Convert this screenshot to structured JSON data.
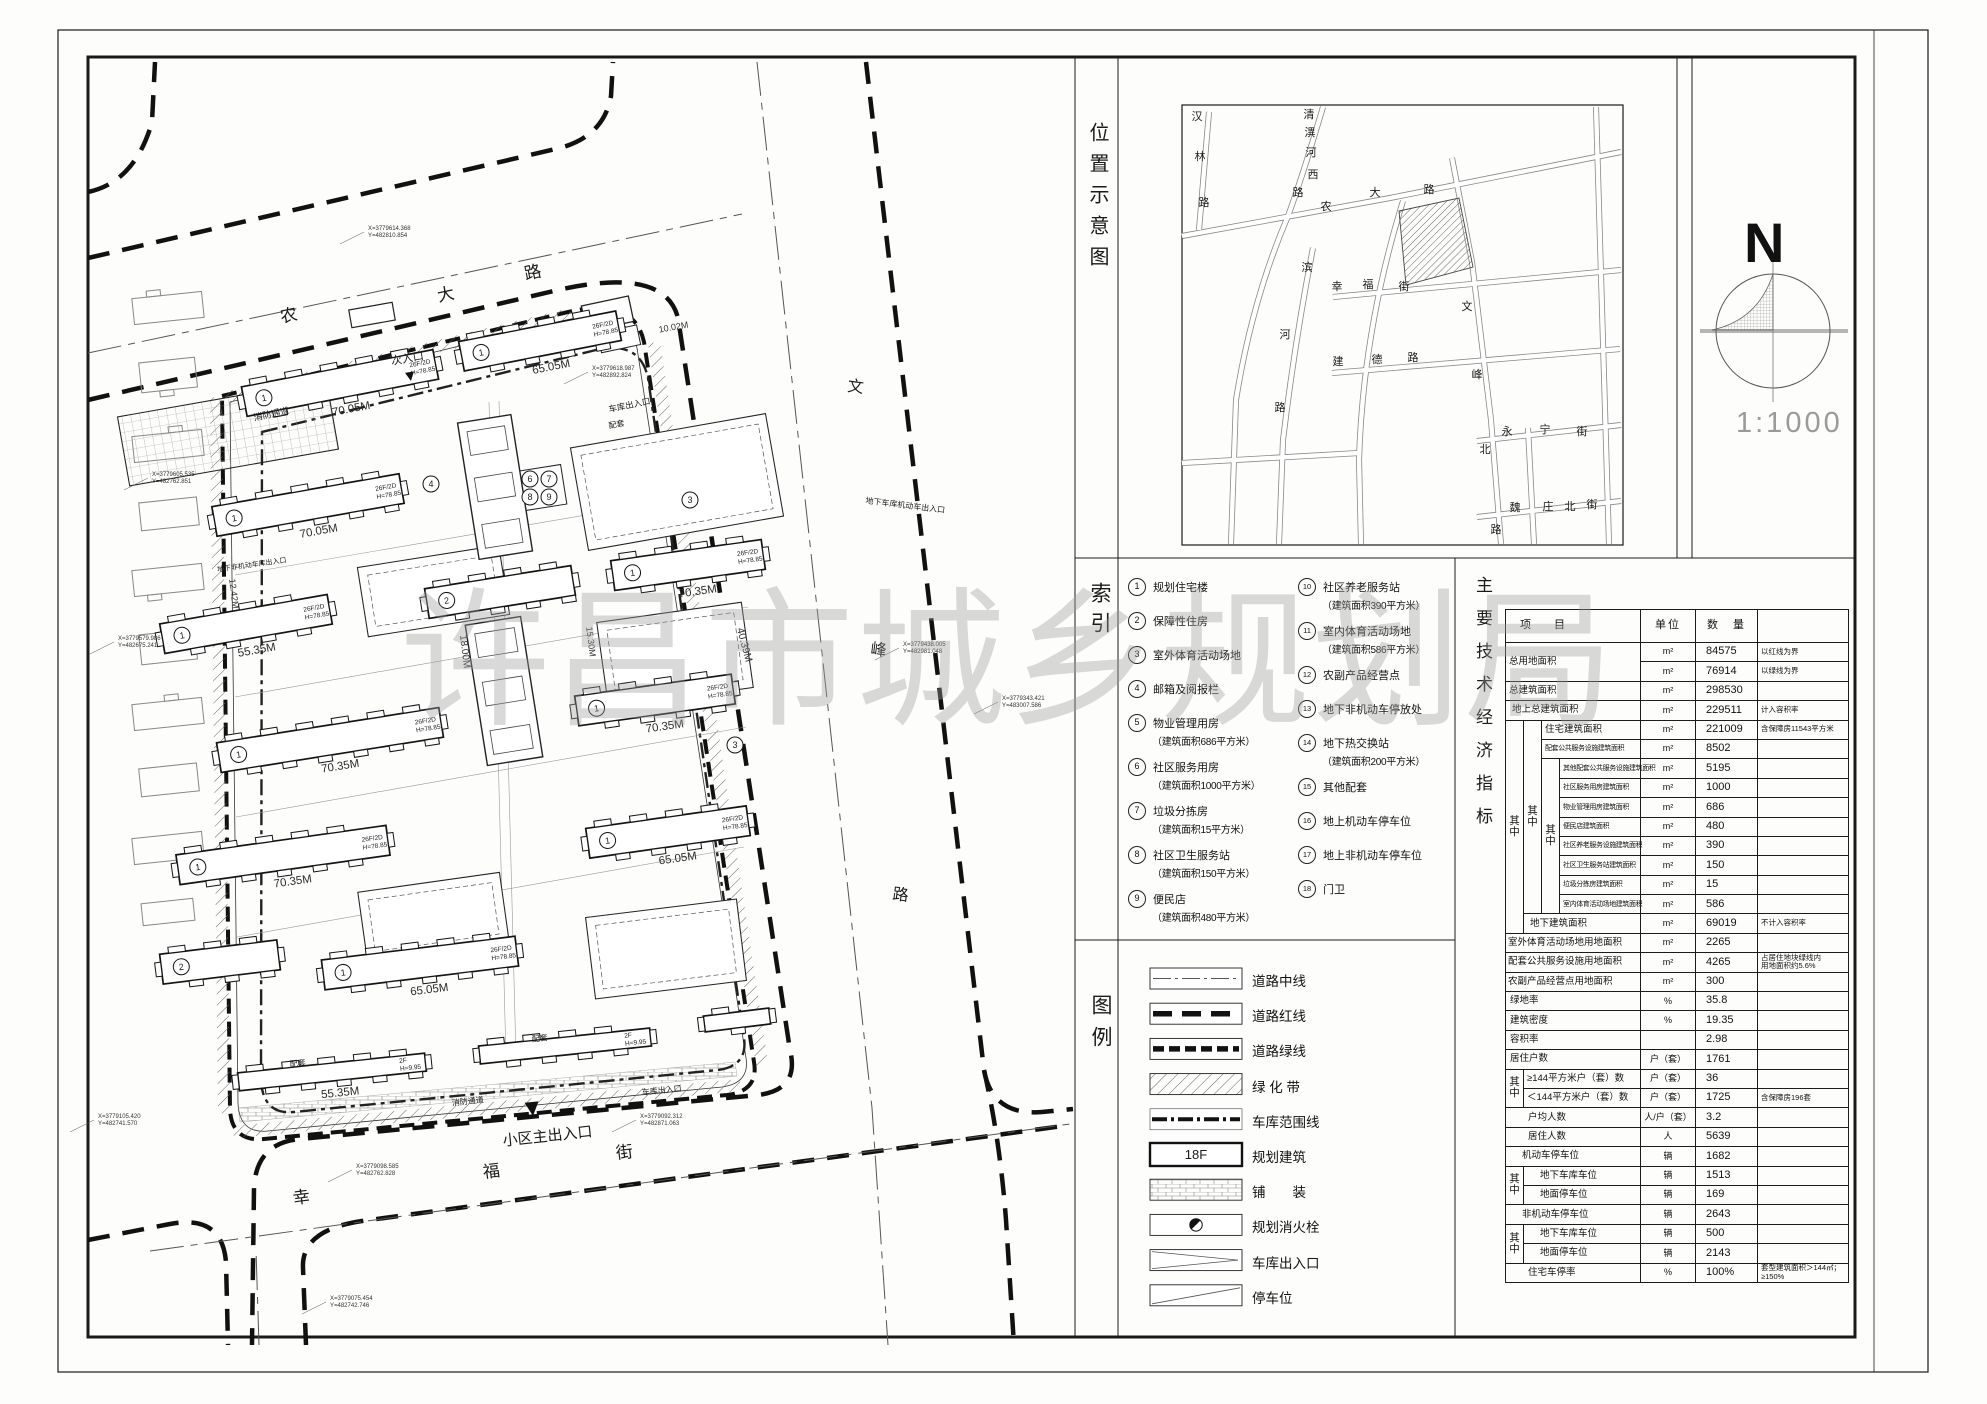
{
  "sheet": {
    "watermark": "许昌市城乡规划局"
  },
  "panels": {
    "location_label": "位置示意图",
    "index_label": "索引",
    "legend_label": "图例",
    "indicators_label": "主要技术经济指标"
  },
  "north": {
    "letter": "N",
    "scale": "1:1000"
  },
  "location_map": {
    "streets": [
      {
        "name": "汉林路",
        "pos": [
          [
            1197,
            120
          ],
          [
            1200,
            160
          ],
          [
            1204,
            206
          ]
        ]
      },
      {
        "name": "清潩河西路",
        "pos": [
          [
            1309,
            118
          ],
          [
            1310,
            136
          ],
          [
            1311,
            156
          ],
          [
            1313,
            178
          ],
          [
            1298,
            196
          ]
        ]
      },
      {
        "name": "农大路",
        "pos": [
          [
            1326,
            210
          ],
          [
            1375,
            196
          ],
          [
            1429,
            193
          ]
        ]
      },
      {
        "name": "滨河路",
        "pos": [
          [
            1307,
            271
          ],
          [
            1285,
            338
          ],
          [
            1280,
            411
          ]
        ]
      },
      {
        "name": "幸福街",
        "pos": [
          [
            1337,
            290
          ],
          [
            1368,
            288
          ],
          [
            1404,
            290
          ]
        ]
      },
      {
        "name": "文峰北路",
        "pos": [
          [
            1467,
            310
          ],
          [
            1477,
            378
          ],
          [
            1485,
            453
          ],
          [
            1496,
            533
          ]
        ]
      },
      {
        "name": "建德路",
        "pos": [
          [
            1338,
            365
          ],
          [
            1377,
            363
          ],
          [
            1413,
            361
          ]
        ]
      },
      {
        "name": "永宁街",
        "pos": [
          [
            1507,
            435
          ],
          [
            1545,
            433
          ],
          [
            1582,
            435
          ]
        ]
      },
      {
        "name": "魏庄北街",
        "pos": [
          [
            1515,
            511
          ],
          [
            1548,
            510
          ],
          [
            1570,
            510
          ],
          [
            1592,
            508
          ]
        ]
      }
    ]
  },
  "index": {
    "col1": [
      {
        "no": "1",
        "text": "规划住宅楼",
        "sub": ""
      },
      {
        "no": "2",
        "text": "保障性住房",
        "sub": ""
      },
      {
        "no": "3",
        "text": "室外体育活动场地",
        "sub": ""
      },
      {
        "no": "4",
        "text": "邮箱及阅报栏",
        "sub": ""
      },
      {
        "no": "5",
        "text": "物业管理用房",
        "sub": "（建筑面积686平方米）"
      },
      {
        "no": "6",
        "text": "社区服务用房",
        "sub": "（建筑面积1000平方米）"
      },
      {
        "no": "7",
        "text": "垃圾分拣房",
        "sub": "（建筑面积15平方米）"
      },
      {
        "no": "8",
        "text": "社区卫生服务站",
        "sub": "（建筑面积150平方米）"
      },
      {
        "no": "9",
        "text": "便民店",
        "sub": "（建筑面积480平方米）"
      }
    ],
    "col2": [
      {
        "no": "10",
        "text": "社区养老服务站",
        "sub": "（建筑面积390平方米）"
      },
      {
        "no": "11",
        "text": "室内体育活动场地",
        "sub": "（建筑面积586平方米）"
      },
      {
        "no": "12",
        "text": "农副产品经营点",
        "sub": ""
      },
      {
        "no": "13",
        "text": "地下非机动车停放处",
        "sub": ""
      },
      {
        "no": "14",
        "text": "地下热交换站",
        "sub": "（建筑面积200平方米）"
      },
      {
        "no": "15",
        "text": "其他配套",
        "sub": ""
      },
      {
        "no": "16",
        "text": "地上机动车停车位",
        "sub": ""
      },
      {
        "no": "17",
        "text": "地上非机动车停车位",
        "sub": ""
      },
      {
        "no": "18",
        "text": "门卫",
        "sub": ""
      }
    ]
  },
  "legend": {
    "floor": "18F",
    "items": [
      {
        "sym": "centerline",
        "label": "道路中线"
      },
      {
        "sym": "redline",
        "label": "道路红线"
      },
      {
        "sym": "greenline",
        "label": "道路绿线"
      },
      {
        "sym": "greenbelt",
        "label": "绿 化 带"
      },
      {
        "sym": "garage",
        "label": "车库范围线"
      },
      {
        "sym": "building",
        "label": "规划建筑"
      },
      {
        "sym": "paving",
        "label": "铺　　装"
      },
      {
        "sym": "hydrant",
        "label": "规划消火栓"
      },
      {
        "sym": "ramp",
        "label": "车库出入口"
      },
      {
        "sym": "parking",
        "label": "停车位"
      }
    ]
  },
  "table": {
    "qz": "其中",
    "headers": {
      "item": "项　目",
      "unit": "单位",
      "qty": "数　量",
      "remark": ""
    },
    "rows": [
      {
        "l": "总用地面积",
        "lrs": 2,
        "cs": 4,
        "u": "m²",
        "q": "84575",
        "r": "以红线为界"
      },
      {
        "l": null,
        "u": "m²",
        "q": "76914",
        "r": "以绿线为界"
      },
      {
        "l": "总建筑面积",
        "cs": 4,
        "u": "m²",
        "q": "298530",
        "r": ""
      },
      {
        "l": "地上总建筑面积",
        "cs": 4,
        "pad": 6,
        "u": "m²",
        "q": "229511",
        "r": "计入容积率"
      },
      {
        "l": "住宅建筑面积",
        "cs": 2,
        "pre": [
          {
            "rs": 11
          },
          {
            "rs": 10
          }
        ],
        "u": "m²",
        "q": "221009",
        "r": "含保障房11543平方米"
      },
      {
        "l": "配套公共服务设施建筑面积",
        "cs": 2,
        "cls": "sm",
        "u": "m²",
        "q": "8502",
        "r": ""
      },
      {
        "l": "其他配套公共服务设施建筑面积",
        "cs": 1,
        "cls": "sm",
        "pre": [
          {
            "rs": 8
          }
        ],
        "u": "m²",
        "q": "5195",
        "r": ""
      },
      {
        "l": "社区服务用房建筑面积",
        "cs": 1,
        "cls": "sm",
        "u": "m²",
        "q": "1000",
        "r": ""
      },
      {
        "l": "物业管理用房建筑面积",
        "cs": 1,
        "cls": "sm",
        "u": "m²",
        "q": "686",
        "r": ""
      },
      {
        "l": "便民店建筑面积",
        "cs": 1,
        "cls": "sm",
        "u": "m²",
        "q": "480",
        "r": ""
      },
      {
        "l": "社区养老服务设施建筑面积",
        "cs": 1,
        "cls": "sm",
        "u": "m²",
        "q": "390",
        "r": ""
      },
      {
        "l": "社区卫生服务站建筑面积",
        "cs": 1,
        "cls": "sm",
        "u": "m²",
        "q": "150",
        "r": ""
      },
      {
        "l": "垃圾分拣房建筑面积",
        "cs": 1,
        "cls": "sm",
        "u": "m²",
        "q": "15",
        "r": ""
      },
      {
        "l": "室内体育活动场地建筑面积",
        "cs": 1,
        "cls": "sm",
        "u": "m²",
        "q": "586",
        "r": ""
      },
      {
        "l": "地下建筑面积",
        "cs": 3,
        "pad": 6,
        "u": "m²",
        "q": "69019",
        "r": "不计入容积率"
      },
      {
        "l": "室外体育活动场地用地面积",
        "cs": 4,
        "pad": 2,
        "u": "m²",
        "q": "2265",
        "r": ""
      },
      {
        "l": "配套公共服务设施用地面积",
        "cs": 4,
        "pad": 2,
        "u": "m²",
        "q": "4265",
        "r": "占居住地块绿线内\n用地面积约5.6%"
      },
      {
        "l": "农副产品经营点用地面积",
        "cs": 4,
        "pad": 2,
        "u": "m²",
        "q": "300",
        "r": ""
      },
      {
        "l": "绿地率",
        "cs": 4,
        "pad": 4,
        "u": "%",
        "q": "35.8",
        "r": ""
      },
      {
        "l": "建筑密度",
        "cs": 4,
        "pad": 4,
        "u": "%",
        "q": "19.35",
        "r": ""
      },
      {
        "l": "容积率",
        "cs": 4,
        "pad": 4,
        "u": "",
        "q": "2.98",
        "r": ""
      },
      {
        "l": "居住户数",
        "cs": 4,
        "pad": 4,
        "u": "户（套）",
        "q": "1761",
        "r": ""
      },
      {
        "l": "≥144平方米户（套）数",
        "cs": 3,
        "pre": [
          {
            "rs": 2
          }
        ],
        "u": "户（套）",
        "q": "36",
        "r": ""
      },
      {
        "l": "＜144平方米户（套）数",
        "cs": 3,
        "u": "户（套）",
        "q": "1725",
        "r": "含保障房196套"
      },
      {
        "l": "户均人数",
        "cs": 4,
        "pad": 22,
        "u": "人/户（套）",
        "q": "3.2",
        "r": ""
      },
      {
        "l": "居住人数",
        "cs": 4,
        "pad": 22,
        "u": "人",
        "q": "5639",
        "r": ""
      },
      {
        "l": "机动车停车位",
        "cs": 4,
        "pad": 16,
        "u": "辆",
        "q": "1682",
        "r": ""
      },
      {
        "l": "地下车库车位",
        "cs": 3,
        "pad": 16,
        "pre": [
          {
            "rs": 2
          }
        ],
        "u": "辆",
        "q": "1513",
        "r": ""
      },
      {
        "l": "地面停车位",
        "cs": 3,
        "pad": 16,
        "u": "辆",
        "q": "169",
        "r": ""
      },
      {
        "l": "非机动车停车位",
        "cs": 4,
        "pad": 16,
        "u": "辆",
        "q": "2643",
        "r": ""
      },
      {
        "l": "地下车库车位",
        "cs": 3,
        "pad": 16,
        "pre": [
          {
            "rs": 2
          }
        ],
        "u": "辆",
        "q": "500",
        "r": ""
      },
      {
        "l": "地面停车位",
        "cs": 3,
        "pad": 16,
        "u": "辆",
        "q": "2143",
        "r": ""
      },
      {
        "l": "住宅车停率",
        "cs": 4,
        "pad": 22,
        "u": "%",
        "q": "100%",
        "r": "套型建筑面积＞144㎡；\n≥150%"
      }
    ]
  },
  "site_plan": {
    "streets": [
      {
        "t": "农",
        "x": 290,
        "y": 321,
        "s": 17,
        "r": -12
      },
      {
        "t": "大",
        "x": 447,
        "y": 300,
        "s": 17,
        "r": -12
      },
      {
        "t": "路",
        "x": 534,
        "y": 278,
        "s": 17,
        "r": -12
      },
      {
        "t": "文",
        "x": 855,
        "y": 392,
        "s": 16,
        "r": 7
      },
      {
        "t": "峰",
        "x": 878,
        "y": 655,
        "s": 16,
        "r": 7
      },
      {
        "t": "路",
        "x": 900,
        "y": 900,
        "s": 16,
        "r": 7
      },
      {
        "t": "幸",
        "x": 302,
        "y": 1203,
        "s": 17,
        "r": -7
      },
      {
        "t": "福",
        "x": 492,
        "y": 1177,
        "s": 17,
        "r": -7
      },
      {
        "t": "街",
        "x": 625,
        "y": 1158,
        "s": 17,
        "r": -7
      }
    ],
    "entrances": [
      {
        "t": "次入口",
        "x": 408,
        "y": 362,
        "s": 11,
        "r": -10
      },
      {
        "t": "小区主出入口",
        "x": 548,
        "y": 1141,
        "s": 15,
        "r": -6
      },
      {
        "t": "消防通道",
        "x": 272,
        "y": 417,
        "s": 9,
        "r": -12
      },
      {
        "t": "消防通道",
        "x": 468,
        "y": 1104,
        "s": 8,
        "r": -6
      },
      {
        "t": "车库出入口",
        "x": 630,
        "y": 408,
        "s": 8.5,
        "r": -12
      },
      {
        "t": "车库出入口",
        "x": 662,
        "y": 1093,
        "s": 8,
        "r": -6
      },
      {
        "t": "地下车库机动车出入口",
        "x": 905,
        "y": 508,
        "s": 8,
        "r": 7
      },
      {
        "t": "地下非机动车库出入口",
        "x": 252,
        "y": 567,
        "s": 7,
        "r": -8
      },
      {
        "t": "配套",
        "x": 617,
        "y": 427,
        "s": 8,
        "r": -11
      },
      {
        "t": "配套",
        "x": 298,
        "y": 1066,
        "s": 8,
        "r": -6
      },
      {
        "t": "配套",
        "x": 540,
        "y": 1041,
        "s": 8,
        "r": -6
      }
    ],
    "arrows": [
      {
        "x": 411,
        "y": 381,
        "r": -10,
        "k": 9
      },
      {
        "x": 533,
        "y": 1116,
        "r": -6,
        "k": 14
      }
    ],
    "dims": [
      {
        "t": "18.00M",
        "x": 462,
        "y": 652,
        "s": 10,
        "r": 83
      },
      {
        "t": "15.30M",
        "x": 588,
        "y": 642,
        "s": 9,
        "r": 83
      },
      {
        "t": "12.42M",
        "x": 231,
        "y": 594,
        "s": 9,
        "r": 83
      },
      {
        "t": "10.02M",
        "x": 674,
        "y": 330,
        "s": 9,
        "r": -10
      }
    ],
    "callouts": [
      {
        "x": 368,
        "y": 230,
        "a": "X=3779614.368",
        "b": "Y=482810.854"
      },
      {
        "x": 592,
        "y": 370,
        "a": "X=3779618.987",
        "b": "Y=482892.824"
      },
      {
        "x": 152,
        "y": 476,
        "a": "X=3779605.535",
        "b": "Y=482762.851"
      },
      {
        "x": 118,
        "y": 640,
        "a": "X=3779579.986",
        "b": "Y=482675.241"
      },
      {
        "x": 98,
        "y": 1118,
        "a": "X=3779105.420",
        "b": "Y=482741.570"
      },
      {
        "x": 356,
        "y": 1168,
        "a": "X=3779098.585",
        "b": "Y=482762.828"
      },
      {
        "x": 640,
        "y": 1118,
        "a": "X=3779092.312",
        "b": "Y=482871.063"
      },
      {
        "x": 903,
        "y": 646,
        "a": "X=3779438.005",
        "b": "Y=482981.048"
      },
      {
        "x": 1002,
        "y": 700,
        "a": "X=3779343.421",
        "b": "Y=483007.586"
      },
      {
        "x": 330,
        "y": 1300,
        "a": "X=3779075.454",
        "b": "Y=482742.746"
      }
    ],
    "buildings": [
      {
        "x": 340,
        "y": 383,
        "w": 195,
        "rot": -11,
        "n": "1",
        "len": "70.05M",
        "f": "26F/2D",
        "fh": "H=78.85"
      },
      {
        "x": 540,
        "y": 341,
        "w": 160,
        "rot": -11,
        "n": "1",
        "len": "65.05M",
        "f": "26F/2D",
        "fh": "H=78.85"
      },
      {
        "x": 308,
        "y": 505,
        "w": 190,
        "rot": -10,
        "n": "1",
        "len": "70.05M",
        "f": "26F/2D",
        "fh": "H=78.85"
      },
      {
        "x": 246,
        "y": 624,
        "w": 170,
        "rot": -10,
        "n": "1",
        "len": "55.35M",
        "f": "26F/2D",
        "fh": "H=78.85"
      },
      {
        "x": 500,
        "y": 592,
        "w": 148,
        "rot": -9,
        "n": "2",
        "len": ""
      },
      {
        "x": 688,
        "y": 565,
        "w": 152,
        "rot": -8,
        "n": "1",
        "len": "70.35M",
        "f": "26F/2D",
        "fh": "H=78.85"
      },
      {
        "x": 330,
        "y": 740,
        "w": 225,
        "rot": -9,
        "n": "1",
        "len": "70.35M",
        "f": "26F/2D",
        "fh": "H=78.85"
      },
      {
        "x": 655,
        "y": 700,
        "w": 158,
        "rot": -8,
        "n": "1",
        "len": "70.35M",
        "f": "26F/2D",
        "fh": "H=78.85"
      },
      {
        "x": 283,
        "y": 855,
        "w": 212,
        "rot": -8,
        "n": "1",
        "len": "70.35M",
        "f": "26F/2D",
        "fh": "H=78.85"
      },
      {
        "x": 668,
        "y": 832,
        "w": 162,
        "rot": -8,
        "n": "1",
        "len": "65.05M",
        "f": "26F/2D",
        "fh": "H=78.85"
      },
      {
        "x": 420,
        "y": 963,
        "w": 195,
        "rot": -7,
        "n": "1",
        "len": "65.05M",
        "f": "26F/2D",
        "fh": "H=78.85"
      },
      {
        "x": 220,
        "y": 962,
        "w": 118,
        "rot": -7,
        "n": "2",
        "len": ""
      },
      {
        "x": 332,
        "y": 1072,
        "w": 188,
        "h": 18,
        "rot": -6,
        "len": "55.35M",
        "f": "2F",
        "fh": "H=9.95"
      },
      {
        "x": 565,
        "y": 1046,
        "w": 172,
        "h": 18,
        "rot": -6,
        "f": "2F",
        "fh": "H=9.95"
      },
      {
        "x": 737,
        "y": 1020,
        "w": 66,
        "h": 16,
        "rot": -7
      }
    ],
    "courts": [
      {
        "x": 122,
        "y": 398,
        "w": 212,
        "h": 70,
        "rot": -10,
        "grid": 1
      },
      {
        "x": 578,
        "y": 430,
        "w": 198,
        "h": 104,
        "rot": -10,
        "inner": 1
      },
      {
        "x": 362,
        "y": 556,
        "w": 143,
        "h": 70,
        "rot": -9,
        "inner": 1
      },
      {
        "x": 602,
        "y": 612,
        "w": 146,
        "h": 86,
        "rot": -8,
        "inner": 1,
        "vlen": "40.39M"
      },
      {
        "x": 362,
        "y": 882,
        "w": 143,
        "h": 70,
        "rot": -8,
        "inner": 1
      },
      {
        "x": 590,
        "y": 908,
        "w": 152,
        "h": 82,
        "rot": -7,
        "inner": 1
      },
      {
        "x": 468,
        "y": 418,
        "w": 54,
        "h": 138,
        "rot": -9,
        "spine": 1
      },
      {
        "x": 476,
        "y": 620,
        "w": 56,
        "h": 142,
        "rot": -9,
        "spine": 1
      }
    ],
    "circles": [
      {
        "n": "3",
        "x": 690,
        "y": 500
      },
      {
        "n": "4",
        "x": 431,
        "y": 484
      },
      {
        "n": "6",
        "x": 530,
        "y": 479
      },
      {
        "n": "7",
        "x": 549,
        "y": 479
      },
      {
        "n": "8",
        "x": 530,
        "y": 497
      },
      {
        "n": "9",
        "x": 549,
        "y": 497
      },
      {
        "n": "3",
        "x": 735,
        "y": 745
      }
    ]
  }
}
